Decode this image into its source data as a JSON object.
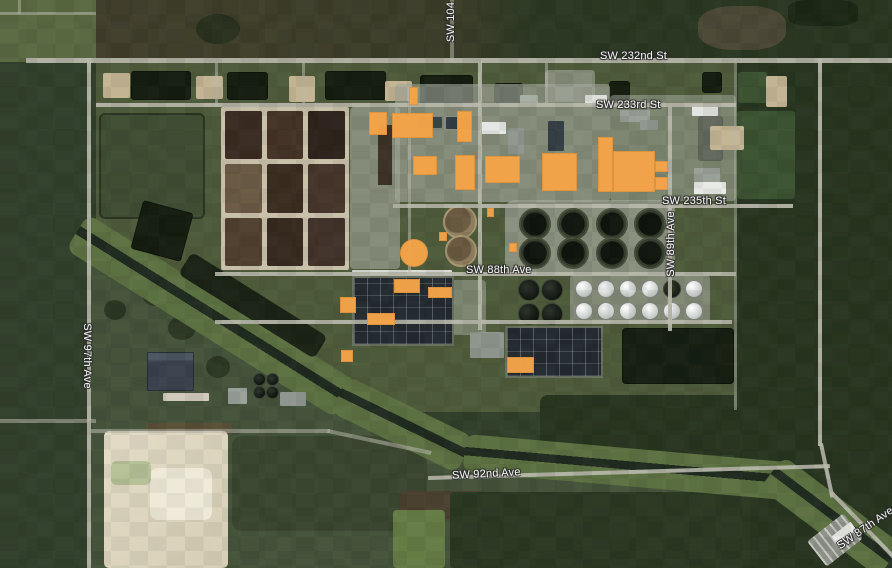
{
  "map": {
    "view": "satellite",
    "street_labels": {
      "sw_104": "SW 104",
      "sw_232nd": "SW 232nd St",
      "sw_233rd": "SW 233rd St",
      "sw_235th": "SW 235th St",
      "sw_88th_ave": "SW 88th Ave",
      "sw_89th_ave": "SW 89th Ave",
      "sw_97th_ave": "SW 97th Ave",
      "sw_92nd_ave": "SW 92nd Ave",
      "sw_87th_ave": "SW 87th Ave"
    },
    "colors": {
      "building_highlight": "#F5A449",
      "road": "#B8B8AB",
      "canal_water": "#202B20",
      "facility_grass": "#4E5B3A",
      "forest": "#28351F",
      "label_text": "#FFFFFF"
    },
    "highlighted_buildings": [
      {
        "x": 369,
        "y": 112,
        "w": 18,
        "h": 23
      },
      {
        "x": 392,
        "y": 113,
        "w": 41,
        "h": 25
      },
      {
        "x": 409,
        "y": 87,
        "w": 9,
        "h": 18
      },
      {
        "x": 457,
        "y": 111,
        "w": 15,
        "h": 31
      },
      {
        "x": 413,
        "y": 156,
        "w": 24,
        "h": 19
      },
      {
        "x": 455,
        "y": 155,
        "w": 20,
        "h": 35
      },
      {
        "x": 485,
        "y": 156,
        "w": 35,
        "h": 27
      },
      {
        "x": 542,
        "y": 153,
        "w": 35,
        "h": 38
      },
      {
        "x": 598,
        "y": 137,
        "w": 15,
        "h": 55
      },
      {
        "x": 613,
        "y": 151,
        "w": 42,
        "h": 41
      },
      {
        "x": 655,
        "y": 161,
        "w": 13,
        "h": 11
      },
      {
        "x": 655,
        "y": 177,
        "w": 13,
        "h": 13
      },
      {
        "x": 487,
        "y": 208,
        "w": 7,
        "h": 9
      },
      {
        "x": 439,
        "y": 232,
        "w": 8,
        "h": 9
      },
      {
        "x": 509,
        "y": 243,
        "w": 8,
        "h": 9
      },
      {
        "x": 394,
        "y": 279,
        "w": 26,
        "h": 14
      },
      {
        "x": 428,
        "y": 287,
        "w": 24,
        "h": 11
      },
      {
        "x": 340,
        "y": 297,
        "w": 16,
        "h": 16
      },
      {
        "x": 367,
        "y": 313,
        "w": 28,
        "h": 12
      },
      {
        "x": 507,
        "y": 357,
        "w": 27,
        "h": 16
      },
      {
        "x": 341,
        "y": 350,
        "w": 12,
        "h": 12
      },
      {
        "x": 400,
        "y": 239,
        "w": 28,
        "h": 28,
        "shape": "circle"
      }
    ]
  }
}
